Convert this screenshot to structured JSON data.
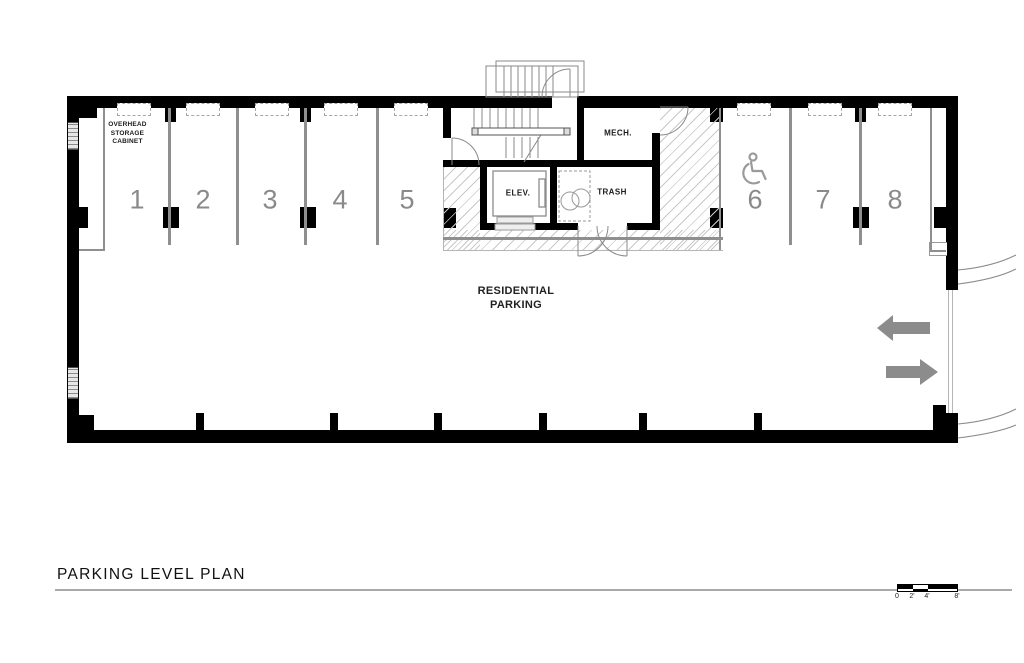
{
  "title": {
    "text": "PARKING LEVEL PLAN"
  },
  "plan": {
    "area_label": {
      "line1": "RESIDENTIAL",
      "line2": "PARKING"
    },
    "storage_note": {
      "line1": "OVERHEAD",
      "line2": "STORAGE",
      "line3": "CABINET"
    },
    "rooms": {
      "mech": "MECH.",
      "elev": "ELEV.",
      "trash": "TRASH"
    },
    "stalls": [
      {
        "number": "1"
      },
      {
        "number": "2"
      },
      {
        "number": "3"
      },
      {
        "number": "4"
      },
      {
        "number": "5"
      },
      {
        "number": "6"
      },
      {
        "number": "7"
      },
      {
        "number": "8"
      }
    ],
    "icons": {
      "accessible": "wheelchair accessible parking symbol",
      "entry_arrow": "arrow pointing left (vehicle entry)",
      "exit_arrow": "arrow pointing right (vehicle exit)"
    },
    "colors": {
      "wall": "#000000",
      "divider": "#8f8f8f",
      "stall_number": "#8a8a8a",
      "arrow": "#8c8c8c",
      "hatch_line": "#c9c9c9"
    }
  },
  "scale_bar": {
    "labels": [
      "0",
      "2'",
      "4'",
      "8'"
    ]
  }
}
